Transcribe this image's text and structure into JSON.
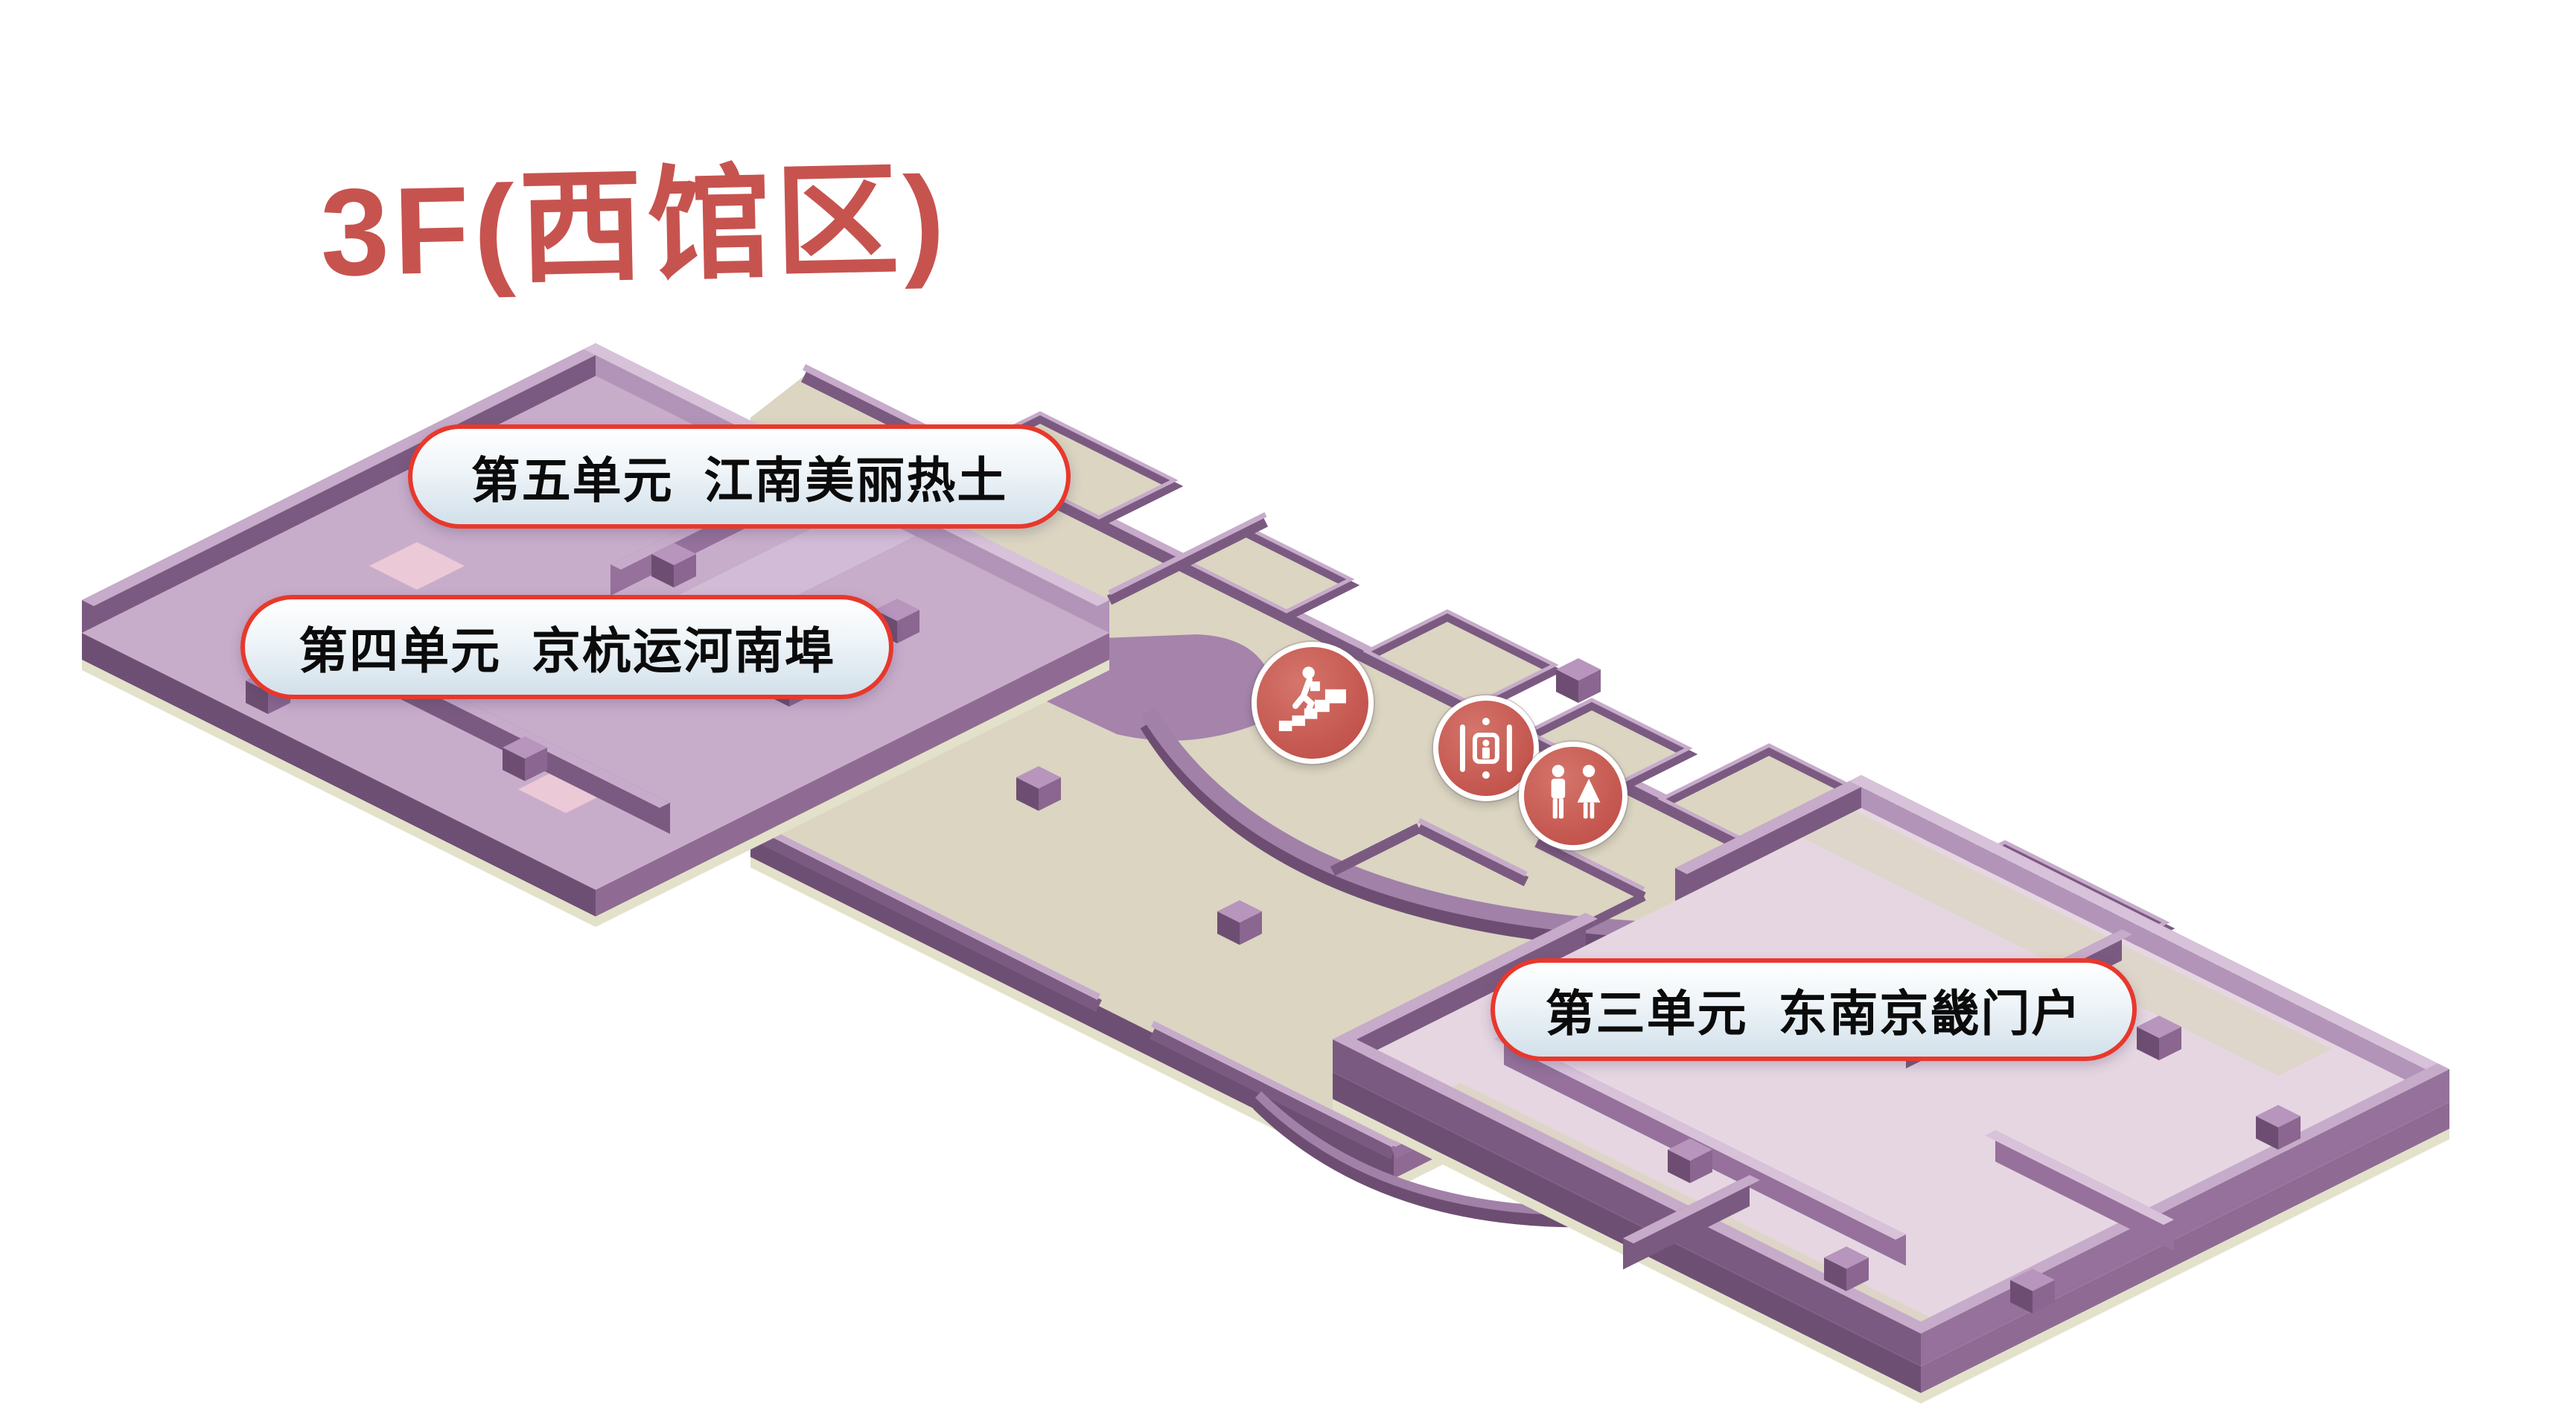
{
  "title": "3F(西馆区)",
  "units": [
    {
      "id": "unit-5",
      "label": "第五单元  江南美丽热土"
    },
    {
      "id": "unit-4",
      "label": "第四单元  京杭运河南埠"
    },
    {
      "id": "unit-3",
      "label": "第三单元  东南京畿门户"
    }
  ],
  "facility_icons": [
    {
      "name": "stairs-icon"
    },
    {
      "name": "elevator-icon"
    },
    {
      "name": "restroom-icon"
    }
  ],
  "colors": {
    "page_bg": "#ffffff",
    "title_red": "#c7534f",
    "label_border": "#e8382c",
    "label_bg_top": "#ffffff",
    "label_bg_bottom": "#d2e0ea",
    "label_text": "#0b0b0b",
    "icon_red": "#c65a52",
    "floor_beige": "#dbd5c2",
    "wing_floor": "#c8adcb",
    "right_wing_floor": "#e6d6e2",
    "wall_dark": "#7b5a81",
    "wall_mid": "#95719b",
    "wall_inner": "#b294b8",
    "wall_cap": "#c7abca",
    "wall_cap_light": "#d8c2da",
    "slab_dark": "#6e4f74",
    "slab_mid": "#8f6b94",
    "slab_cream": "#e3e1ca",
    "cube_top": "#b795bd",
    "cube_left": "#6d4e72",
    "cube_right": "#8a6690",
    "accent_pink": "#ecc9d6",
    "walkway": "#d6c0d9",
    "arc_light": "#a181a8",
    "arc_dark": "#6d4e72",
    "blob": "#a583ab"
  }
}
